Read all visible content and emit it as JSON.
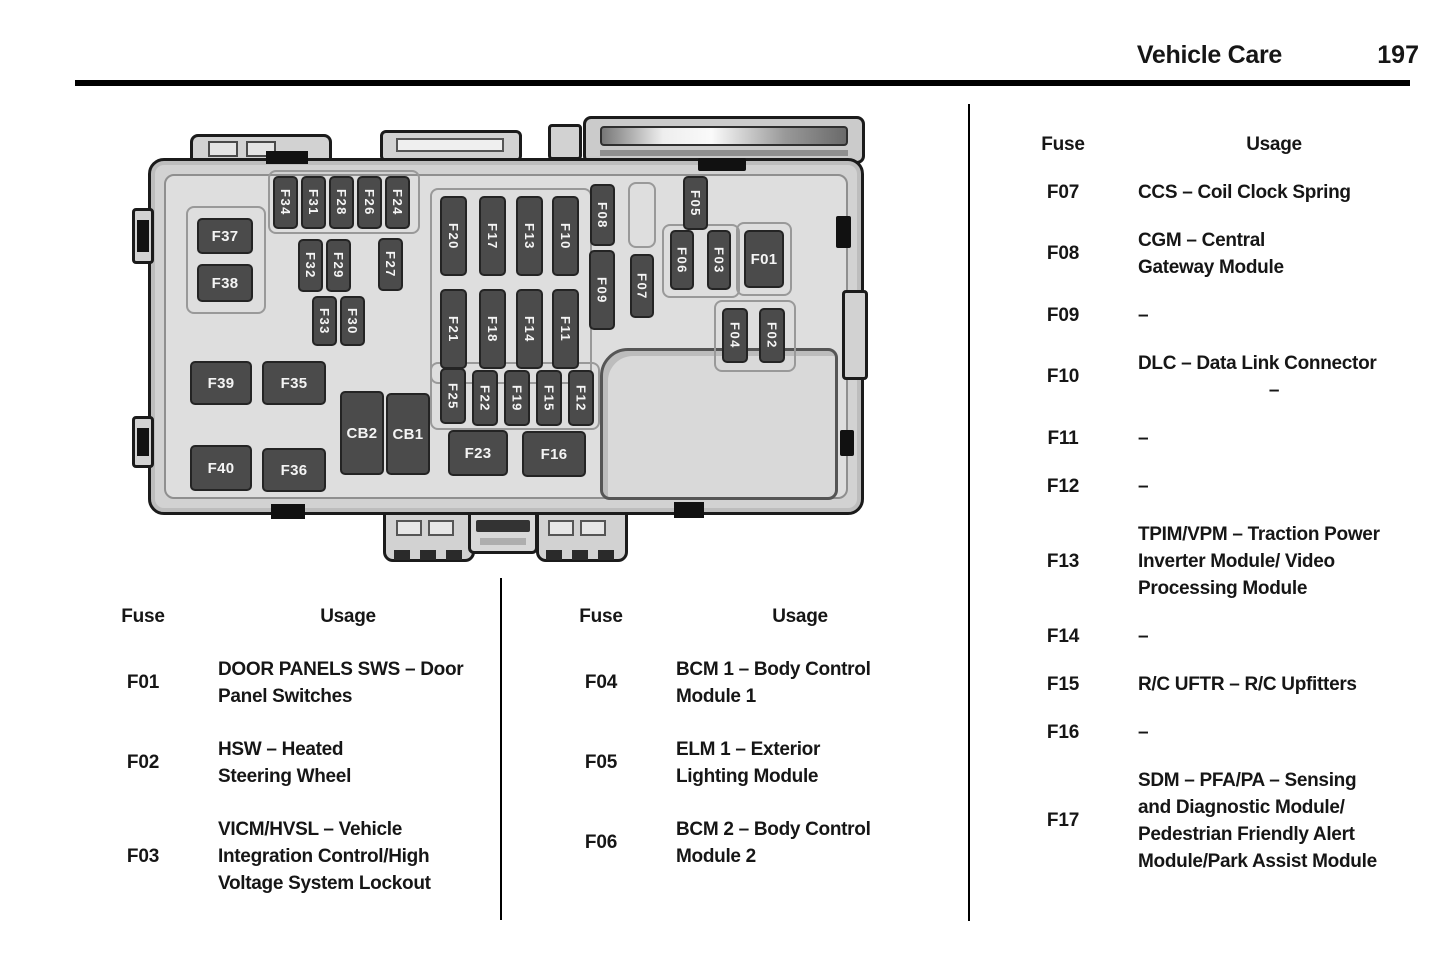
{
  "header": {
    "section_title": "Vehicle Care",
    "page_number": "197"
  },
  "diagram": {
    "fuses": [
      {
        "label": "F37",
        "x": 69,
        "y": 118,
        "w": 56,
        "h": 36,
        "dir": "h"
      },
      {
        "label": "F38",
        "x": 69,
        "y": 164,
        "w": 56,
        "h": 38,
        "dir": "h"
      },
      {
        "label": "F39",
        "x": 62,
        "y": 261,
        "w": 62,
        "h": 44,
        "dir": "h"
      },
      {
        "label": "F35",
        "x": 134,
        "y": 261,
        "w": 64,
        "h": 44,
        "dir": "h"
      },
      {
        "label": "F40",
        "x": 62,
        "y": 345,
        "w": 62,
        "h": 46,
        "dir": "h"
      },
      {
        "label": "F36",
        "x": 134,
        "y": 348,
        "w": 64,
        "h": 44,
        "dir": "h"
      },
      {
        "label": "CB2",
        "x": 212,
        "y": 291,
        "w": 44,
        "h": 84,
        "dir": "h"
      },
      {
        "label": "CB1",
        "x": 258,
        "y": 293,
        "w": 44,
        "h": 82,
        "dir": "h"
      },
      {
        "label": "F23",
        "x": 320,
        "y": 330,
        "w": 60,
        "h": 46,
        "dir": "h"
      },
      {
        "label": "F16",
        "x": 394,
        "y": 331,
        "w": 64,
        "h": 46,
        "dir": "h"
      },
      {
        "label": "F01",
        "x": 616,
        "y": 130,
        "w": 40,
        "h": 58,
        "dir": "h"
      },
      {
        "label": "F34",
        "x": 145,
        "y": 76,
        "w": 25,
        "h": 53,
        "dir": "v"
      },
      {
        "label": "F31",
        "x": 173,
        "y": 76,
        "w": 25,
        "h": 53,
        "dir": "v"
      },
      {
        "label": "F28",
        "x": 201,
        "y": 76,
        "w": 25,
        "h": 53,
        "dir": "v"
      },
      {
        "label": "F26",
        "x": 229,
        "y": 76,
        "w": 25,
        "h": 53,
        "dir": "v"
      },
      {
        "label": "F24",
        "x": 257,
        "y": 76,
        "w": 25,
        "h": 53,
        "dir": "v"
      },
      {
        "label": "F32",
        "x": 170,
        "y": 139,
        "w": 25,
        "h": 53,
        "dir": "v"
      },
      {
        "label": "F29",
        "x": 198,
        "y": 139,
        "w": 25,
        "h": 53,
        "dir": "v"
      },
      {
        "label": "F27",
        "x": 250,
        "y": 138,
        "w": 25,
        "h": 53,
        "dir": "v"
      },
      {
        "label": "F33",
        "x": 184,
        "y": 196,
        "w": 25,
        "h": 50,
        "dir": "v"
      },
      {
        "label": "F30",
        "x": 212,
        "y": 196,
        "w": 25,
        "h": 50,
        "dir": "v"
      },
      {
        "label": "F20",
        "x": 312,
        "y": 96,
        "w": 27,
        "h": 80,
        "dir": "v"
      },
      {
        "label": "F17",
        "x": 351,
        "y": 96,
        "w": 27,
        "h": 80,
        "dir": "v"
      },
      {
        "label": "F13",
        "x": 388,
        "y": 96,
        "w": 27,
        "h": 80,
        "dir": "v"
      },
      {
        "label": "F10",
        "x": 424,
        "y": 96,
        "w": 27,
        "h": 80,
        "dir": "v"
      },
      {
        "label": "F21",
        "x": 312,
        "y": 189,
        "w": 27,
        "h": 80,
        "dir": "v"
      },
      {
        "label": "F18",
        "x": 351,
        "y": 189,
        "w": 27,
        "h": 80,
        "dir": "v"
      },
      {
        "label": "F14",
        "x": 388,
        "y": 189,
        "w": 27,
        "h": 80,
        "dir": "v"
      },
      {
        "label": "F11",
        "x": 424,
        "y": 189,
        "w": 27,
        "h": 80,
        "dir": "v"
      },
      {
        "label": "F08",
        "x": 462,
        "y": 84,
        "w": 25,
        "h": 62,
        "dir": "v"
      },
      {
        "label": "F09",
        "x": 461,
        "y": 150,
        "w": 26,
        "h": 80,
        "dir": "v"
      },
      {
        "label": "F07",
        "x": 502,
        "y": 154,
        "w": 24,
        "h": 64,
        "dir": "v"
      },
      {
        "label": "F05",
        "x": 555,
        "y": 76,
        "w": 25,
        "h": 54,
        "dir": "v"
      },
      {
        "label": "F06",
        "x": 542,
        "y": 130,
        "w": 24,
        "h": 60,
        "dir": "v"
      },
      {
        "label": "F03",
        "x": 579,
        "y": 130,
        "w": 24,
        "h": 60,
        "dir": "v"
      },
      {
        "label": "F04",
        "x": 594,
        "y": 208,
        "w": 26,
        "h": 55,
        "dir": "v"
      },
      {
        "label": "F02",
        "x": 631,
        "y": 208,
        "w": 26,
        "h": 55,
        "dir": "v"
      },
      {
        "label": "F25",
        "x": 312,
        "y": 268,
        "w": 26,
        "h": 56,
        "dir": "v"
      },
      {
        "label": "F22",
        "x": 344,
        "y": 270,
        "w": 26,
        "h": 56,
        "dir": "v"
      },
      {
        "label": "F19",
        "x": 376,
        "y": 270,
        "w": 26,
        "h": 56,
        "dir": "v"
      },
      {
        "label": "F15",
        "x": 408,
        "y": 270,
        "w": 26,
        "h": 56,
        "dir": "v"
      },
      {
        "label": "F12",
        "x": 440,
        "y": 270,
        "w": 26,
        "h": 56,
        "dir": "v"
      }
    ]
  },
  "tables": [
    {
      "position": "bottom-left",
      "headers": {
        "fuse": "Fuse",
        "usage": "Usage"
      },
      "rows": [
        {
          "id": "F01",
          "usage": "DOOR PANELS SWS – Door\nPanel Switches"
        },
        {
          "id": "F02",
          "usage": "HSW – Heated\nSteering Wheel"
        },
        {
          "id": "F03",
          "usage": "VICM/HVSL – Vehicle\nIntegration Control/High\nVoltage System Lockout"
        }
      ]
    },
    {
      "position": "bottom-middle",
      "headers": {
        "fuse": "Fuse",
        "usage": "Usage"
      },
      "rows": [
        {
          "id": "F04",
          "usage": "BCM 1 – Body Control\nModule 1"
        },
        {
          "id": "F05",
          "usage": "ELM 1 – Exterior\nLighting Module"
        },
        {
          "id": "F06",
          "usage": "BCM 2 – Body Control\nModule 2"
        }
      ]
    },
    {
      "position": "right-column",
      "headers": {
        "fuse": "Fuse",
        "usage": "Usage"
      },
      "rows": [
        {
          "id": "F07",
          "usage": "CCS – Coil Clock Spring"
        },
        {
          "id": "F08",
          "usage": "CGM – Central\nGateway Module"
        },
        {
          "id": "F09",
          "usage": "–"
        },
        {
          "id": "F10",
          "usage": "DLC – Data Link Connector",
          "usage_centered": "–"
        },
        {
          "id": "F11",
          "usage": "–"
        },
        {
          "id": "F12",
          "usage": "–"
        },
        {
          "id": "F13",
          "usage": "TPIM/VPM – Traction Power\nInverter Module/ Video\nProcessing Module"
        },
        {
          "id": "F14",
          "usage": "–"
        },
        {
          "id": "F15",
          "usage": "R/C UFTR – R/C Upfitters"
        },
        {
          "id": "F16",
          "usage": "–"
        },
        {
          "id": "F17",
          "usage": "SDM – PFA/PA – Sensing\nand Diagnostic Module/\nPedestrian Friendly Alert\nModule/Park Assist Module"
        }
      ]
    }
  ]
}
